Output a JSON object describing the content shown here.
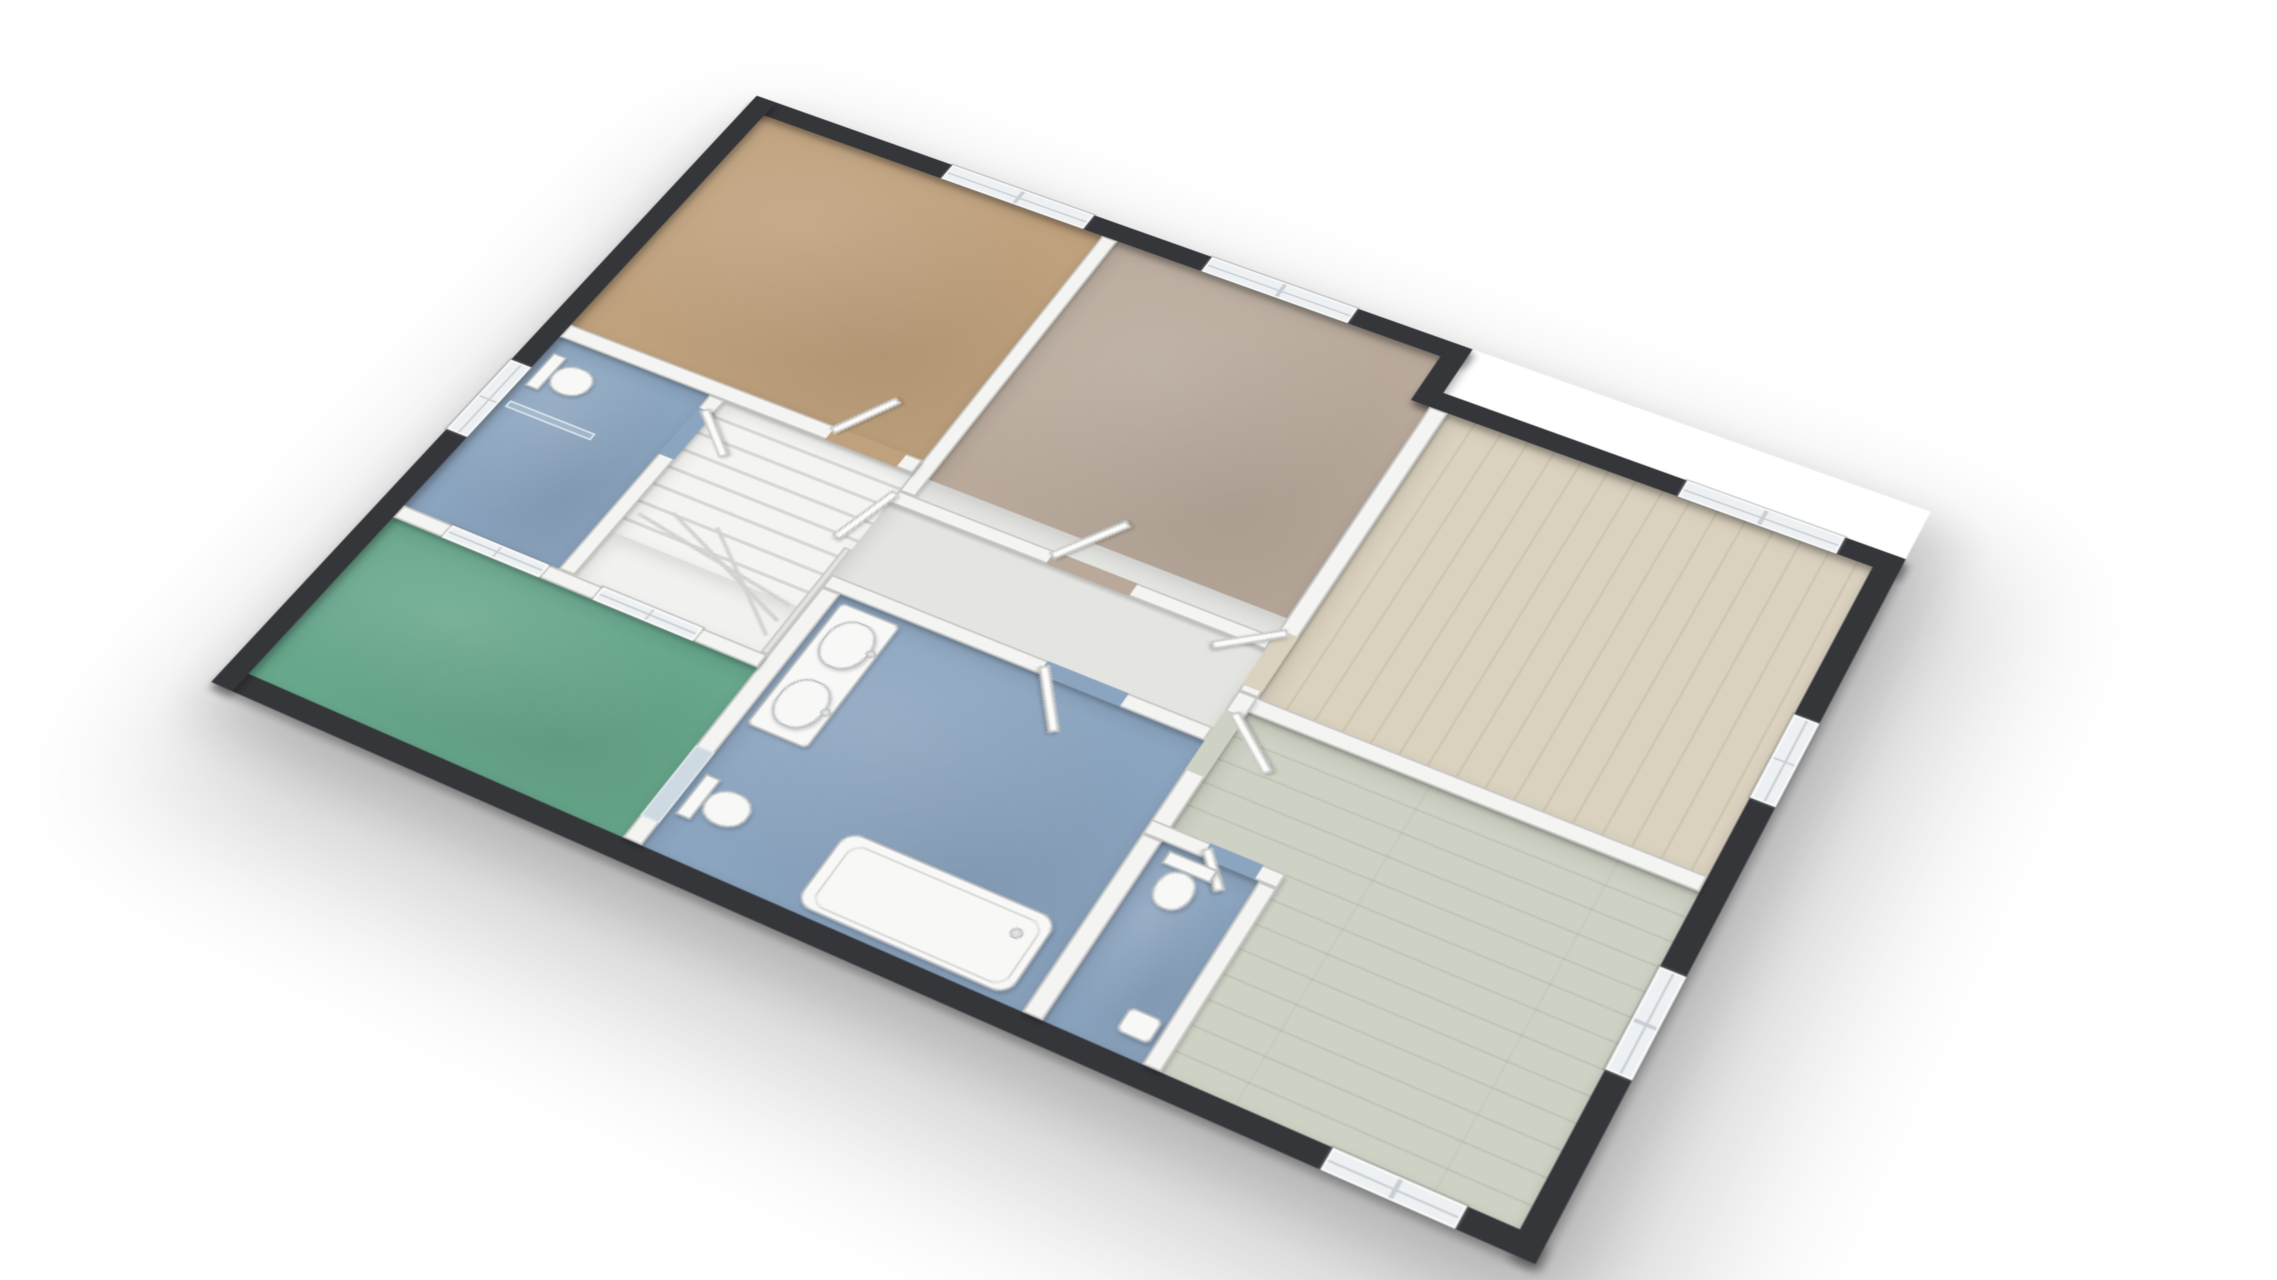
{
  "scene": {
    "type": "3d-floor-plan-render",
    "view": "isometric-from-south-west",
    "background": "#ffffff",
    "visible_text": "none"
  },
  "palette": {
    "page_bg": "#ffffff",
    "exterior_wall": "#34363a",
    "interior_wall": "#f4f4f2",
    "interior_wall_edge": "#c6c6c3",
    "window_glass": "#eef1f3",
    "window_frame": "#fbfbfa",
    "fixture_fill": "#f8f8f7",
    "fixture_edge": "#b9bcbe",
    "glass_panel": "rgba(173,196,214,0.55)",
    "stair_line": "#d2d2cf"
  },
  "rooms": {
    "bedroom_nw": {
      "label": "bedroom-northwest-tan-carpet",
      "floor": "#bfa17d"
    },
    "bedroom_n": {
      "label": "bedroom-north-taupe-carpet",
      "floor": "#b8a99b"
    },
    "bedroom_ne": {
      "label": "bedroom-northeast-light-wood",
      "floor": "#dad1be"
    },
    "room_se": {
      "label": "room-southeast-sage-wood",
      "floor": "#cdd2c4"
    },
    "hall": {
      "label": "hall-landing",
      "floor": "#e4e4e1"
    },
    "stairwell": {
      "label": "stairwell",
      "floor": "#f1f1ef"
    },
    "wc_small": {
      "label": "wc-northwest",
      "floor": "#8ba4bf"
    },
    "bathroom": {
      "label": "bathroom",
      "floor": "#8ba4bf"
    },
    "wc_second": {
      "label": "wc-south",
      "floor": "#8ba4bf"
    },
    "terrace": {
      "label": "terrace-green",
      "floor": "#67a78c"
    }
  },
  "windows": [
    {
      "room": "bedroom_nw",
      "wall": "north",
      "panes": 4
    },
    {
      "room": "bedroom_n",
      "wall": "north",
      "panes": 4
    },
    {
      "room": "bedroom_ne",
      "wall": "north",
      "panes": 4
    },
    {
      "room": "bedroom_ne",
      "wall": "east",
      "panes": 4
    },
    {
      "room": "room_se",
      "wall": "east",
      "panes": 4
    },
    {
      "room": "room_se",
      "wall": "south",
      "panes": 4
    },
    {
      "room": "wc_small",
      "wall": "west",
      "panes": 4
    },
    {
      "room": "terrace_facade",
      "wall": "north",
      "panes": 4
    },
    {
      "room": "terrace_facade",
      "wall": "north",
      "panes": 4
    }
  ],
  "doors": [
    {
      "from": "stair-landing",
      "to": "bedroom_nw"
    },
    {
      "from": "hall",
      "to": "bedroom_n"
    },
    {
      "from": "hall",
      "to": "bedroom_ne"
    },
    {
      "from": "hall",
      "to": "room_se"
    },
    {
      "from": "hall",
      "to": "bathroom"
    },
    {
      "from": "landing",
      "to": "wc_small"
    },
    {
      "from": "room_se",
      "to": "wc_second"
    },
    {
      "from": "bathroom",
      "to": "terrace",
      "type": "glass"
    }
  ],
  "fixtures": [
    {
      "room": "wc_small",
      "items": [
        "toilet",
        "glass-screen"
      ]
    },
    {
      "room": "bathroom",
      "items": [
        "double-sink-vanity",
        "bathtub",
        "toilet"
      ]
    },
    {
      "room": "wc_second",
      "items": [
        "toilet",
        "corner-sink"
      ]
    },
    {
      "room": "stairwell",
      "items": [
        "l-shaped-winder-staircase",
        "railing"
      ]
    }
  ]
}
